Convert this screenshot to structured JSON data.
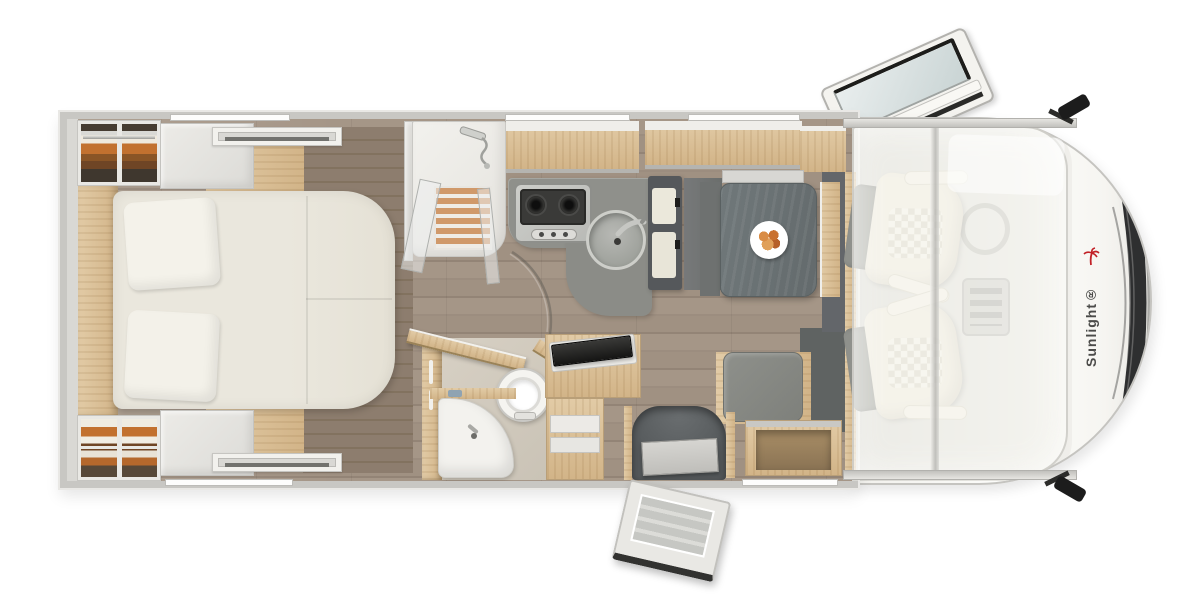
{
  "meta": {
    "view": "motorhome-floor-plan-top-view",
    "canvas_width": 1200,
    "canvas_height": 600
  },
  "brand": {
    "logo_text": "Sunlight®"
  },
  "colors": {
    "brand_red": "#c22127",
    "logo_gray": "#4b4b49",
    "body_white": "#fbfaf8",
    "wall_gray": "#c8c7c3",
    "trim_light": "#e9e8e5",
    "floor_plank": "#a09184",
    "wood_dark": "#8a7a6b",
    "oak": "#e2cba6",
    "oak_deep": "#d2b488",
    "cabinet_white": "#e4e3df",
    "bed_cream": "#eae7dd",
    "counter_gray": "#8f908b",
    "table_slate": "#6c7476",
    "fridge_dark": "#55585b",
    "seat_cream": "#eee9dc",
    "seat_gray": "#9b9d98",
    "step_dark": "#585c5e",
    "windshield_dark": "#2e2f30",
    "shower_slat": "#d0996a",
    "clothes_orange": "#c2712f",
    "clothes_brown": "#6f4525",
    "glass_blue": "#dfe6e6"
  },
  "zones": [
    {
      "id": "bedroom",
      "items": [
        "island-bed",
        "pillow",
        "pillow",
        "wardrobe",
        "wardrobe",
        "overhead-cabinet",
        "overhead-cabinet",
        "roof-vent",
        "roof-vent",
        "headboard-panel"
      ]
    },
    {
      "id": "washroom",
      "items": [
        "shower-cabin",
        "duckboard",
        "glass-door",
        "toilet",
        "corner-washbasin",
        "bathroom-door",
        "tv-unit"
      ]
    },
    {
      "id": "kitchen",
      "items": [
        "gas-hob",
        "round-sink",
        "kitchen-counter",
        "refrigerator",
        "overhead-cabinet"
      ]
    },
    {
      "id": "dinette",
      "items": [
        "dinette-table",
        "breakfast-plate",
        "side-seat",
        "storage-bench",
        "sideboard"
      ]
    },
    {
      "id": "entry",
      "items": [
        "step-well",
        "entry-door",
        "drawer-cabinet"
      ]
    },
    {
      "id": "cab",
      "items": [
        "driver-seat",
        "passenger-seat",
        "steering-wheel",
        "center-console",
        "windshield",
        "wing-mirror",
        "wing-mirror",
        "drop-down-bed",
        "roof-skylight",
        "brand-logo"
      ]
    }
  ],
  "counts": {
    "seats_in_cab": 2,
    "hob_burners_visible": 2,
    "wardrobes": 2,
    "roof_vents": 2
  }
}
